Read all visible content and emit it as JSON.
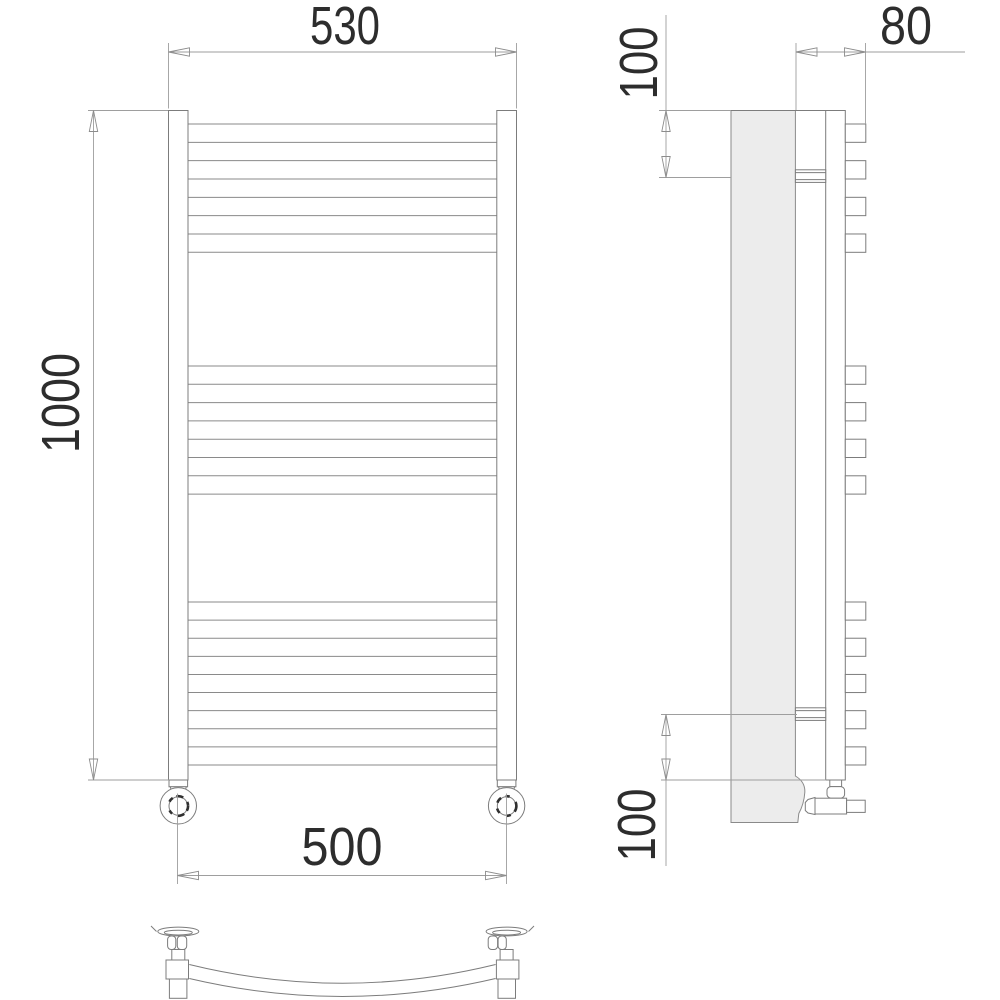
{
  "drawing_type": "towel-radiator-technical-drawing",
  "dimensions": {
    "front": {
      "width_top": "530",
      "height": "1000",
      "width_bottom": "500"
    },
    "side": {
      "depth": "80",
      "top_offset": "100",
      "bottom_offset": "100"
    }
  },
  "colors": {
    "background": "#ffffff",
    "outline": "#7c7c7c",
    "dimension_lines": "#9e9e9e",
    "text": "#2d2d2d",
    "side_panel_fill": "#ececec"
  }
}
